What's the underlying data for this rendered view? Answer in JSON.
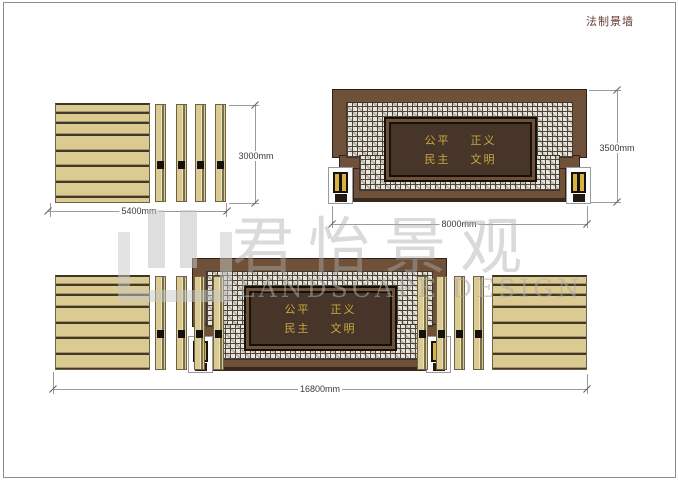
{
  "title": "法制景墙",
  "dimensions": {
    "left_panel_width": "5400mm",
    "left_panel_height": "3000mm",
    "feature_wall_width": "8000mm",
    "feature_wall_height": "3500mm",
    "total_width": "16800mm"
  },
  "wall_text": {
    "r1a": "公平",
    "r1b": "正义",
    "r2a": "民主",
    "r2b": "文明"
  },
  "watermark": {
    "cn": "君怡景观",
    "en": "LANDSCAPE DESIGN"
  },
  "colors": {
    "wood": "#dcca93",
    "wall_brown": "#6f5038",
    "panel_dark": "#463528",
    "gold_text": "#c9a943",
    "lattice_bg": "#e9e5da",
    "title_red": "#6a3a35",
    "dimension_line": "#9b9b9b"
  }
}
